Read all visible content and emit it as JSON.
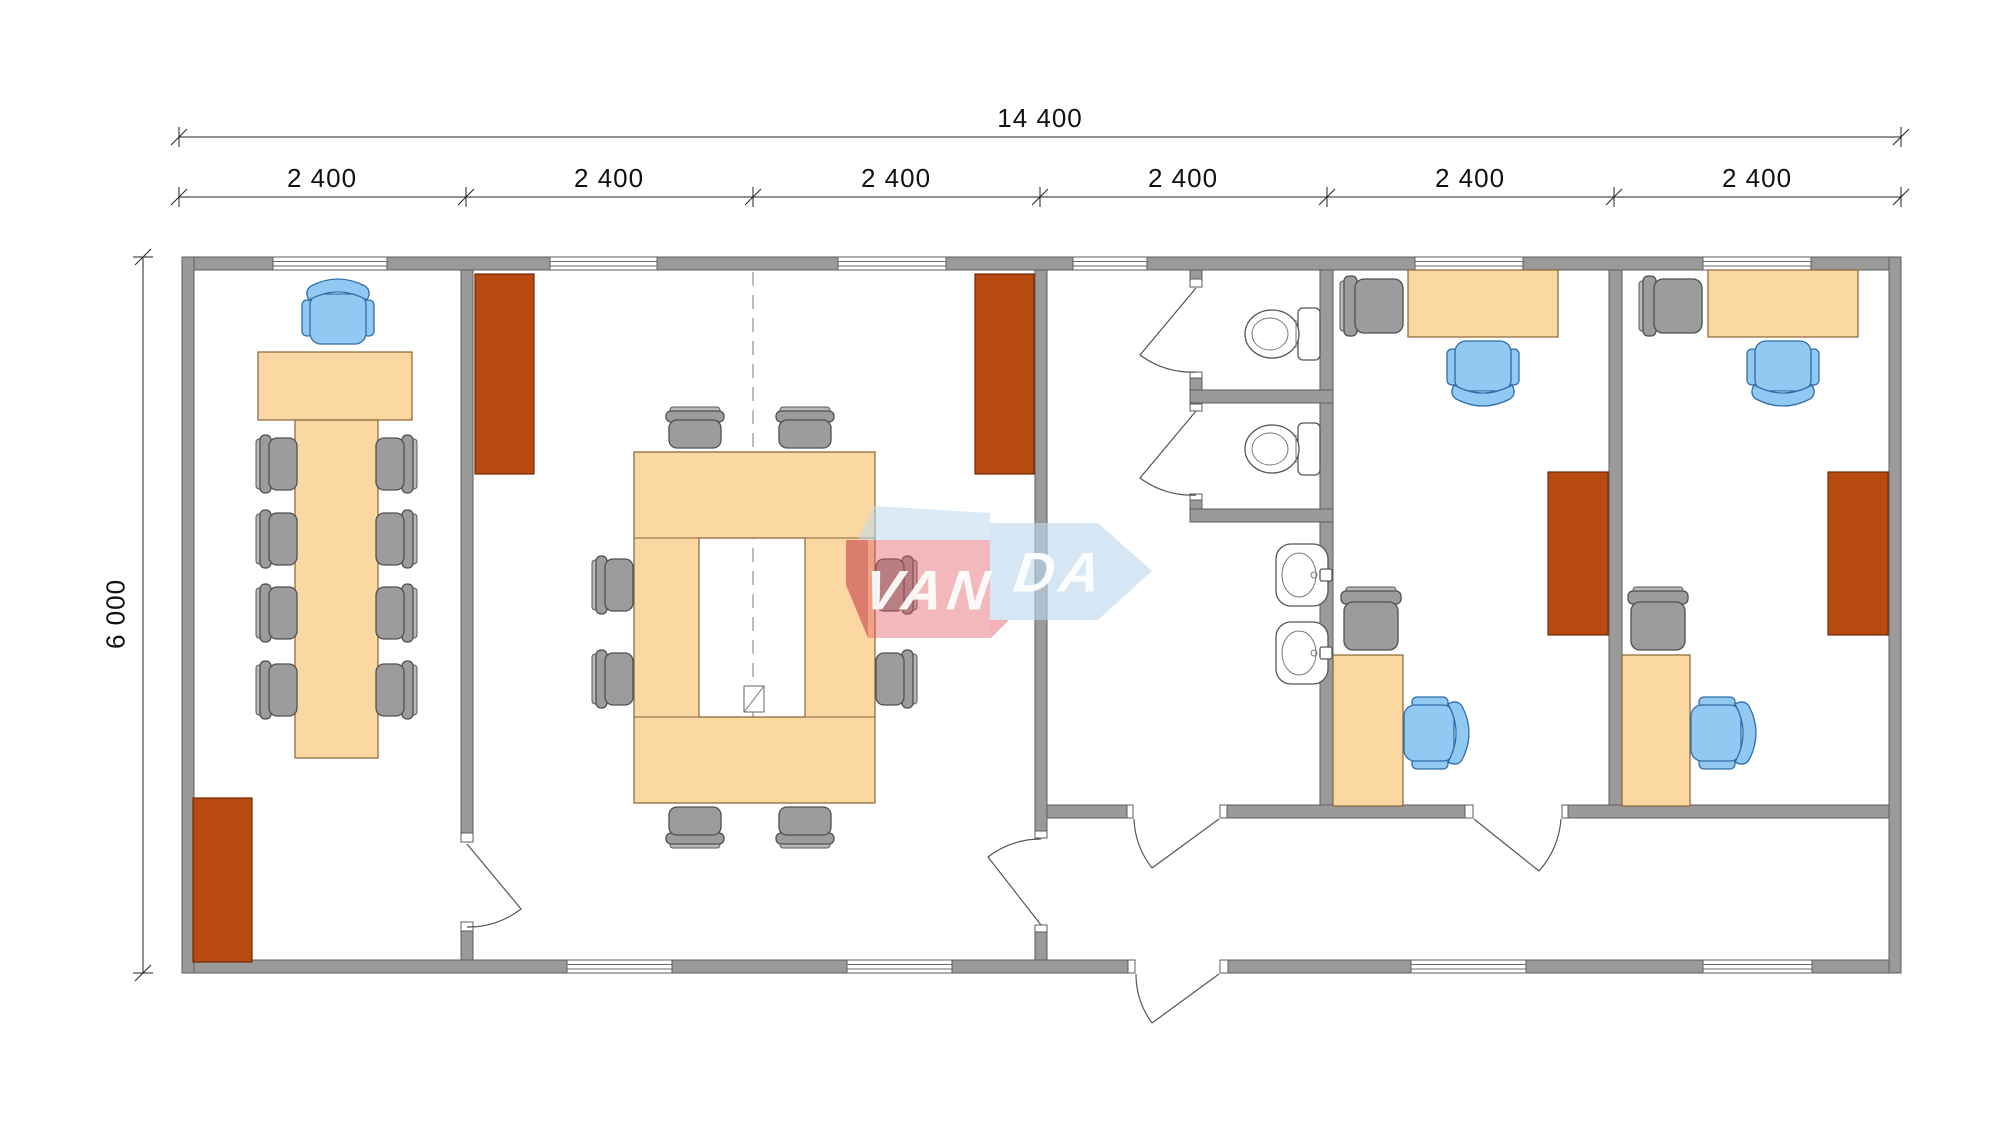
{
  "dimensions": {
    "total": "14 400",
    "height": "6 000",
    "modules": [
      "2 400",
      "2 400",
      "2 400",
      "2 400",
      "2 400",
      "2 400"
    ]
  },
  "logo": {
    "van": "VAN",
    "da": "DA",
    "full": "VANDA"
  },
  "colors": {
    "wall": "#9a9a9a",
    "desk": "#fbd7a2",
    "cabinet": "#b8490f",
    "chair_gray": "#9c9c9c",
    "chair_gray_light": "#b8b8b8",
    "chair_blue": "#92c9f2",
    "logo_red": "#e25560",
    "logo_blue": "#bcd9ee"
  },
  "rooms": [
    {
      "id": "meeting-room",
      "furniture": [
        "desk",
        "blue-executive-chair",
        "long-table",
        "8-side-chairs",
        "cabinet"
      ]
    },
    {
      "id": "conference-room",
      "furniture": [
        "ring-conference-table",
        "8-side-chairs",
        "2-cabinets"
      ]
    },
    {
      "id": "wc-area",
      "furniture": [
        "2-toilet-stalls",
        "2-toilets",
        "2-sinks"
      ]
    },
    {
      "id": "office-1",
      "furniture": [
        "2-desks",
        "2-gray-chairs",
        "2-blue-chairs",
        "cabinet"
      ]
    },
    {
      "id": "office-2",
      "furniture": [
        "2-desks",
        "2-gray-chairs",
        "2-blue-chairs",
        "cabinet"
      ]
    }
  ]
}
